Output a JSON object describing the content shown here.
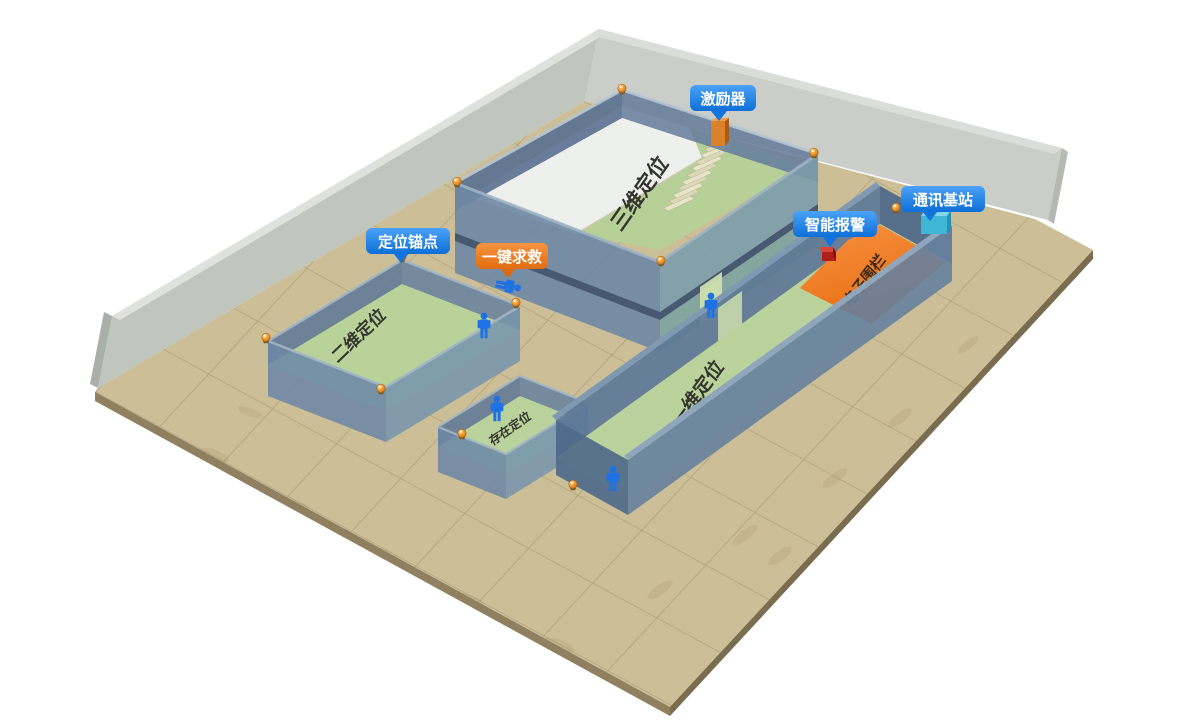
{
  "badges": {
    "exciter": {
      "label": "激励器",
      "color": "#1f88f0",
      "target": "exciter-device"
    },
    "base_station": {
      "label": "通讯基站",
      "color": "#1f88f0",
      "target": "base-station-device"
    },
    "smart_alarm": {
      "label": "智能报警",
      "color": "#1f88f0",
      "target": "alarm-device"
    },
    "anchor": {
      "label": "定位锚点",
      "color": "#1f88f0",
      "target": "anchor-dot"
    },
    "sos": {
      "label": "一键求救",
      "color": "#ee7d1c",
      "target": "fallen-person"
    }
  },
  "zones": {
    "z3d": {
      "label": "三维定位"
    },
    "z2d": {
      "label": "二维定位"
    },
    "presence": {
      "label": "存在定位"
    },
    "z1d": {
      "label": "一维定位"
    },
    "fence": {
      "label": "电子围栏"
    }
  },
  "colors": {
    "badge_blue": "#1f88f0",
    "badge_orange": "#ee7d1c",
    "fence_orange": "#ef7d20",
    "floor_green": "#b8d29a",
    "ground_tan": "#ccbe97",
    "wall_blue": "#6d88a6",
    "glass_wall_gray": "#bcc0b8",
    "person_blue": "#1e72e4",
    "anchor_orange": "#f09a2e",
    "station_cyan": "#3fb6d6",
    "alarm_red": "#b02018",
    "exciter_orange": "#d9822b"
  },
  "icons": [
    "anchor-icon",
    "person-icon",
    "fallen-person-icon",
    "exciter-device-icon",
    "base-station-icon",
    "alarm-device-icon",
    "stairs"
  ]
}
